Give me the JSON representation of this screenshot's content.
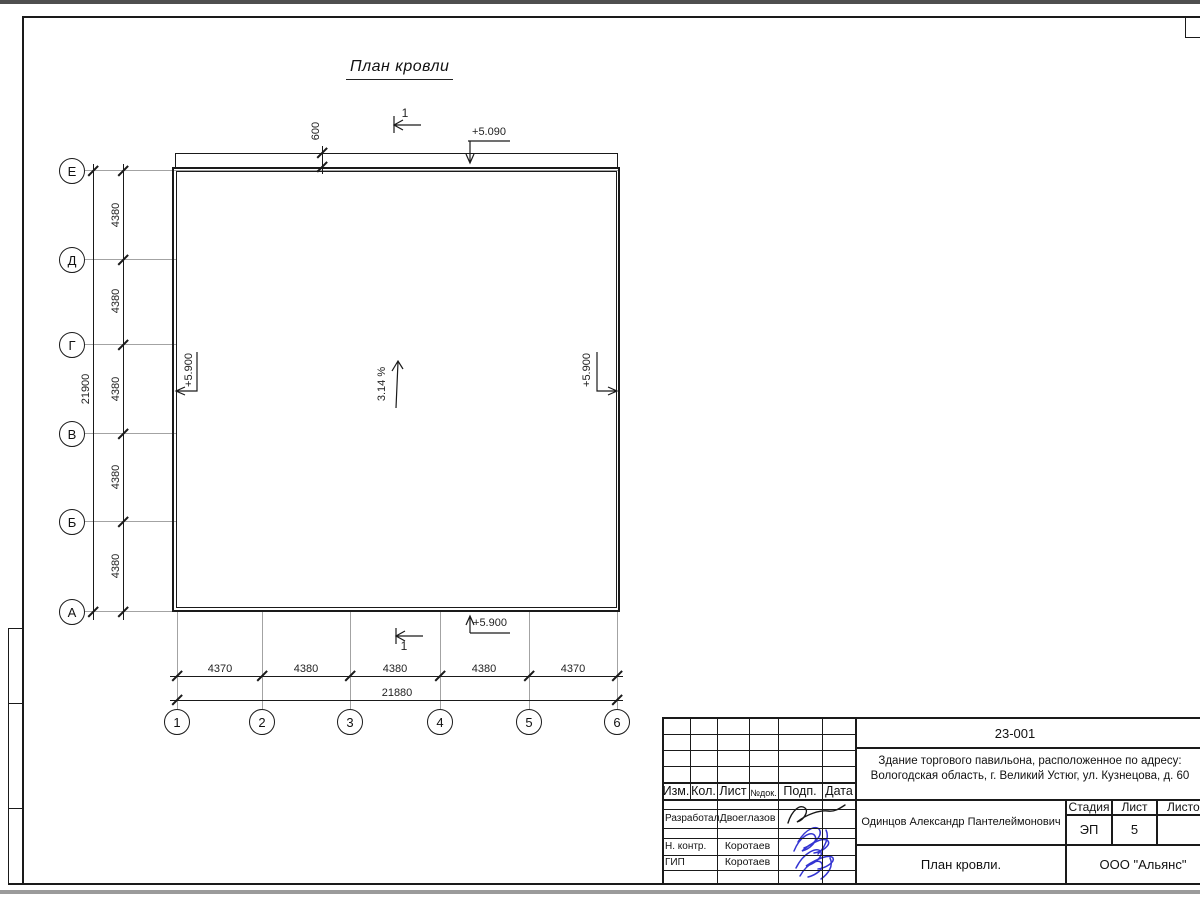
{
  "page": {
    "title": "План кровли"
  },
  "axes": {
    "rows": [
      "Е",
      "Д",
      "Г",
      "В",
      "Б",
      "А"
    ],
    "cols": [
      "1",
      "2",
      "3",
      "4",
      "5",
      "6"
    ]
  },
  "dims": {
    "left_segments": [
      "4380",
      "4380",
      "4380",
      "4380",
      "4380"
    ],
    "left_total": "21900",
    "bottom_segments": [
      "4370",
      "4380",
      "4380",
      "4380",
      "4370"
    ],
    "bottom_total": "21880",
    "overhang": "600"
  },
  "marks": {
    "elev_top": "+5.090",
    "elev_left": "+5.900",
    "elev_right": "+5.900",
    "elev_bottom": "+5.900",
    "slope": "3.14 %",
    "section": "1"
  },
  "titleblock": {
    "doc_number": "23-001",
    "project_line1": "Здание торгового павильона, расположенное по адресу:",
    "project_line2": "Вологодская область, г. Великий Устюг, ул. Кузнецова, д. 60",
    "header": {
      "izm": "Изм.",
      "kol": "Кол.",
      "list": "Лист",
      "ndok": "№док.",
      "podp": "Подп.",
      "data": "Дата"
    },
    "rows": [
      {
        "role": "Разработал",
        "name": "Двоеглазов"
      },
      {
        "role": "Н. контр.",
        "name": "Коротаев"
      },
      {
        "role": "ГИП",
        "name": "Коротаев"
      }
    ],
    "author": "Одинцов Александр Пантелеймонович",
    "stage_label": "Стадия",
    "sheet_label": "Лист",
    "sheets_label": "Листов",
    "stage": "ЭП",
    "sheet": "5",
    "drawing_title": "План кровли.",
    "company": "ООО \"Альянс\""
  },
  "colors": {
    "line": "#1a1a1a",
    "grid": "#a3a3a3",
    "signature_blue": "#2a2ad0"
  }
}
